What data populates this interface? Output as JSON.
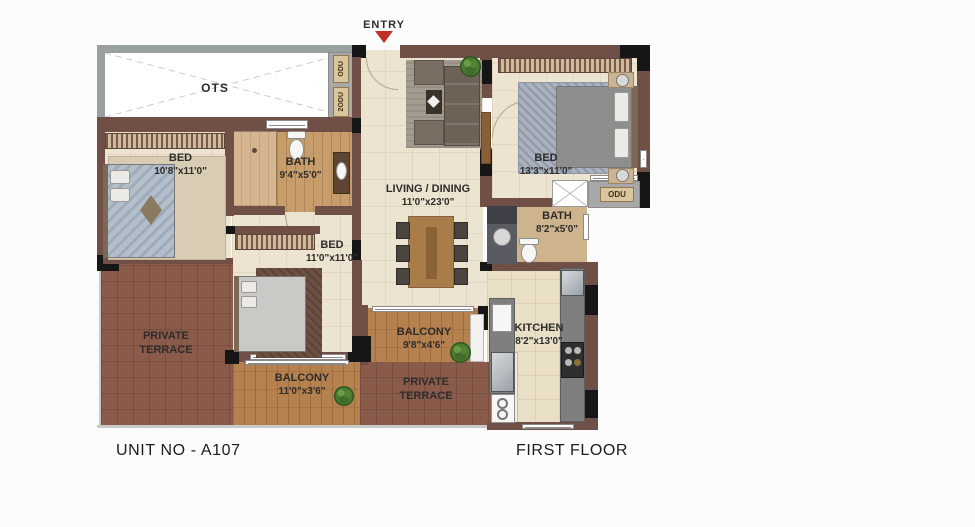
{
  "captions": {
    "unit_no": "UNIT NO - A107",
    "floor": "FIRST FLOOR"
  },
  "entry": {
    "label": "ENTRY"
  },
  "rooms": {
    "ots": {
      "label": "OTS"
    },
    "bed_left": {
      "label": "BED",
      "dims": "10'8\"x11'0\""
    },
    "bath_left": {
      "label": "BATH",
      "dims": "9'4\"x5'0\""
    },
    "living_dining": {
      "label": "LIVING / DINING",
      "dims": "11'0\"x23'0\""
    },
    "bed_right": {
      "label": "BED",
      "dims": "13'3\"x11'0\""
    },
    "bath_right": {
      "label": "BATH",
      "dims": "8'2\"x5'0\""
    },
    "bed_middle": {
      "label": "BED",
      "dims": "11'0\"x11'0\""
    },
    "kitchen": {
      "label": "KITCHEN",
      "dims": "8'2\"x13'0\""
    },
    "balcony_middle": {
      "label": "BALCONY",
      "dims": "9'8\"x4'6\""
    },
    "balcony_left": {
      "label": "BALCONY",
      "dims": "11'0\"x3'6\""
    },
    "private_terrace_left": {
      "label": "PRIVATE TERRACE"
    },
    "private_terrace_middle": {
      "label": "PRIVATE TERRACE"
    }
  },
  "odu_labels": {
    "ots_top": "ODU",
    "ots_bottom": "2ODU",
    "right": "ODU"
  },
  "colors": {
    "wall": "#6f4f46",
    "floor": "#ece3d0",
    "terrace": "#8a5a4b",
    "balcony_wood": "#b5814f",
    "entry_arrow": "#c03024"
  }
}
